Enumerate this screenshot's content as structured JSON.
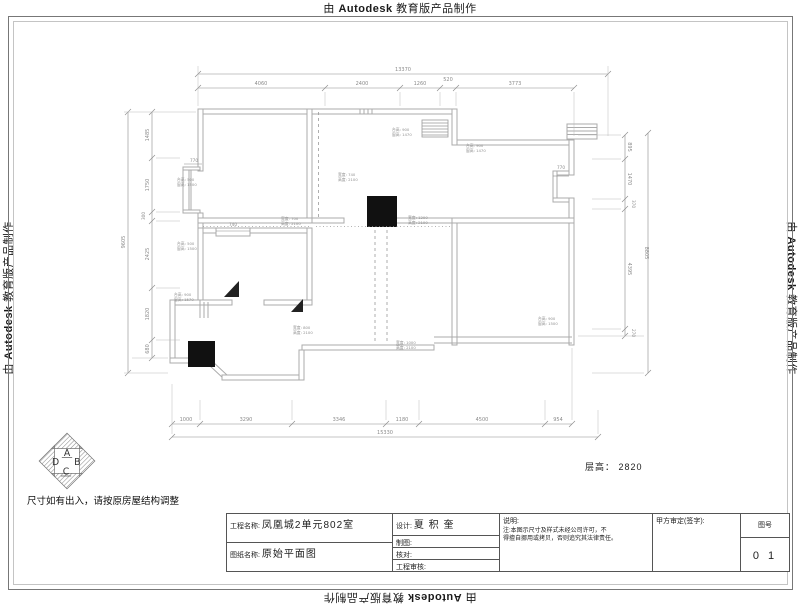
{
  "watermark": {
    "prefix": "由",
    "brand": "Autodesk",
    "suffix": "教育版产品制作"
  },
  "notes": {
    "resize_note": "尺寸如有出入，请按原房屋结构调整",
    "floor_height_label": "层高：",
    "floor_height_value": "2820"
  },
  "logo": {
    "letters": [
      "A",
      "B",
      "C",
      "D"
    ]
  },
  "title_block": {
    "project_label": "工程名称:",
    "project_value": "凤凰城2单元802室",
    "sheet_label": "图纸名称:",
    "sheet_value": "原始平面图",
    "design_label": "设计:",
    "design_value": "夏 积 奎",
    "draft_label": "制图:",
    "check_label": "核对:",
    "review_label": "工程审核:",
    "desc_label": "说明:",
    "desc_note_1": "注:本图示尺寸及样式未经公司许可，不",
    "desc_note_2": "得擅自挪用或拷贝，否则追究其法律责任。",
    "approval_label": "甲方审定(签字):",
    "sheet_no_label": "图号",
    "sheet_no_value": "0 1"
  },
  "plan": {
    "dims_top_overall": "13370",
    "dims_top": [
      "4060",
      "2400",
      "1260",
      "520",
      "3773"
    ],
    "dims_bottom": [
      "1000",
      "3290",
      "3346",
      "1180",
      "4500",
      "954"
    ],
    "dims_bottom_overall": "15330",
    "dims_left": [
      "1485",
      "1750",
      "300",
      "2425",
      "1820",
      "680"
    ],
    "dims_left_overall": "9605",
    "dims_right": [
      "895",
      "1470",
      "370",
      "4395",
      "270"
    ],
    "dims_right_overall": "8805",
    "wall_dims": {
      "bay_left": "770",
      "niche_left": "740",
      "niche_right": "770"
    },
    "annotations": [
      {
        "l1": "台高: 500",
        "l2": "窗高: 1500"
      },
      {
        "l1": "台高: 500",
        "l2": "窗高: 1500"
      },
      {
        "l1": "台高: 900",
        "l2": "窗高: 1570"
      },
      {
        "l1": "台高: 900",
        "l2": "窗高: 1470"
      },
      {
        "l1": "台高: 900",
        "l2": "窗高: 1470"
      },
      {
        "l1": "宽度: 740",
        "l2": "高度: 2100"
      },
      {
        "l1": "宽度: 700",
        "l2": "高度: 2100"
      },
      {
        "l1": "宽度: 1200",
        "l2": "高度: 2100"
      },
      {
        "l1": "宽度: 800",
        "l2": "高度: 2100"
      },
      {
        "l1": "宽度: 1000",
        "l2": "高度: 2100"
      },
      {
        "l1": "台高: 900",
        "l2": "窗高: 1500"
      }
    ]
  }
}
